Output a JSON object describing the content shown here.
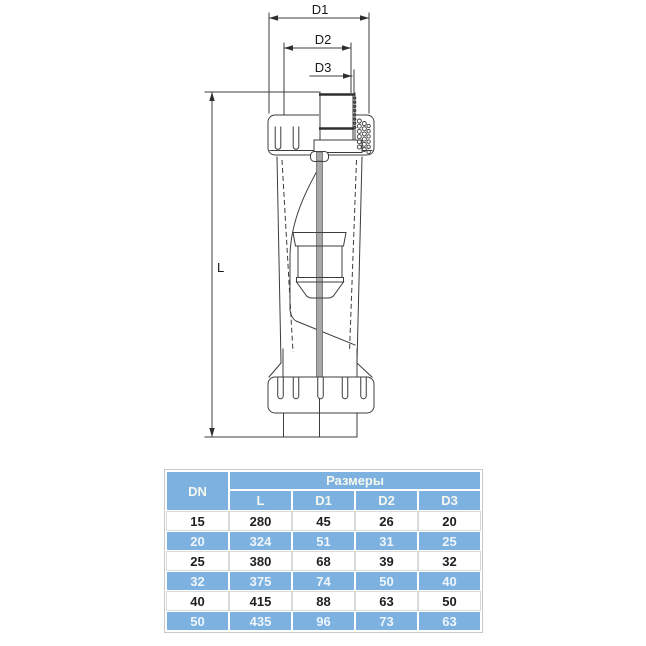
{
  "drawing": {
    "labels": {
      "d1": "D1",
      "d2": "D2",
      "d3": "D3",
      "length": "L"
    }
  },
  "table": {
    "corner_header": "DN",
    "group_header": "Размеры",
    "sub_headers": [
      "L",
      "D1",
      "D2",
      "D3"
    ],
    "rows": [
      {
        "dn": "15",
        "values": [
          "280",
          "45",
          "26",
          "20"
        ]
      },
      {
        "dn": "20",
        "values": [
          "324",
          "51",
          "31",
          "25"
        ]
      },
      {
        "dn": "25",
        "values": [
          "380",
          "68",
          "39",
          "32"
        ]
      },
      {
        "dn": "32",
        "values": [
          "375",
          "74",
          "50",
          "40"
        ]
      },
      {
        "dn": "40",
        "values": [
          "415",
          "88",
          "63",
          "50"
        ]
      },
      {
        "dn": "50",
        "values": [
          "435",
          "96",
          "73",
          "63"
        ]
      }
    ]
  },
  "colors": {
    "accent_blue": "#7cb1e0",
    "table_grid": "#dadada",
    "drawing_line": "#3c3c3c",
    "header_text": "#f5f8ee",
    "highlight_text": "#eef5fc",
    "body_text": "#1f1f1f"
  }
}
